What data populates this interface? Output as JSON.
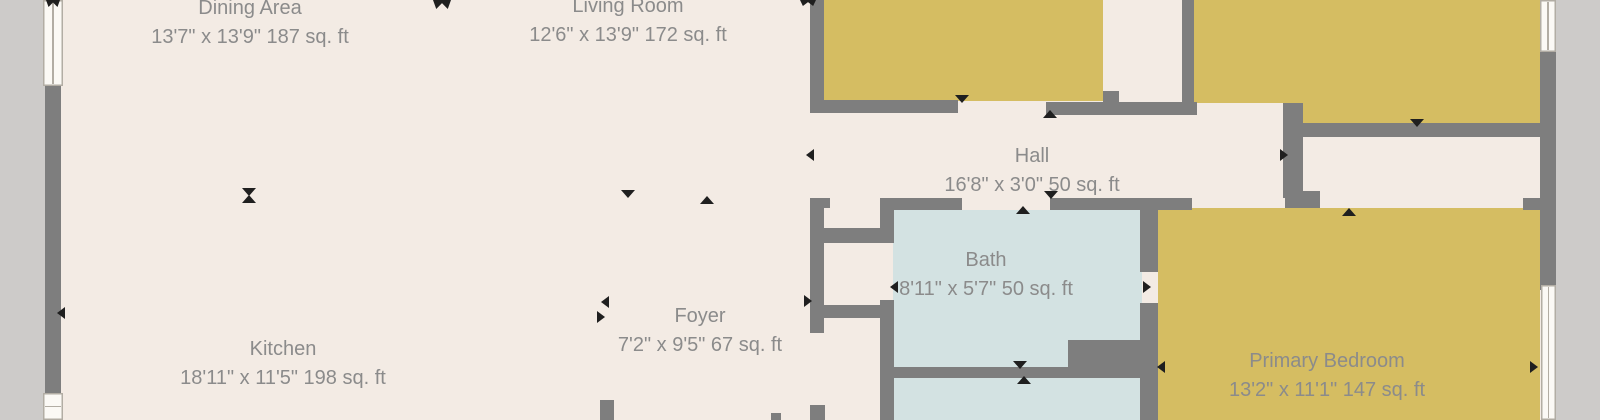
{
  "plan_title": "floor-plan",
  "rooms": [
    {
      "name": "Dining Area",
      "dims": "13'7\" x 13'9\" 187 sq. ft"
    },
    {
      "name": "Living Room",
      "dims": "12'6\" x 13'9\" 172 sq. ft"
    },
    {
      "name": "Hall",
      "dims": "16'8\" x 3'0\" 50 sq. ft"
    },
    {
      "name": "Bath",
      "dims": "8'11\" x 5'7\" 50 sq. ft"
    },
    {
      "name": "Foyer",
      "dims": "7'2\" x 9'5\" 67 sq. ft"
    },
    {
      "name": "Kitchen",
      "dims": "18'11\" x 11'5\" 198 sq. ft"
    },
    {
      "name": "Primary Bedroom",
      "dims": "13'2\" x 11'1\" 147 sq. ft"
    }
  ],
  "colors": {
    "background": "#cdcbc9",
    "floor": "#f3ebe4",
    "bedroom_fill": "#d5bd62",
    "bath_fill": "#d3e2e2",
    "wall": "#7e7e7e",
    "label_text": "#8b8b8b",
    "marker": "#1f1f1f",
    "window_fill": "#fbf9f5"
  }
}
